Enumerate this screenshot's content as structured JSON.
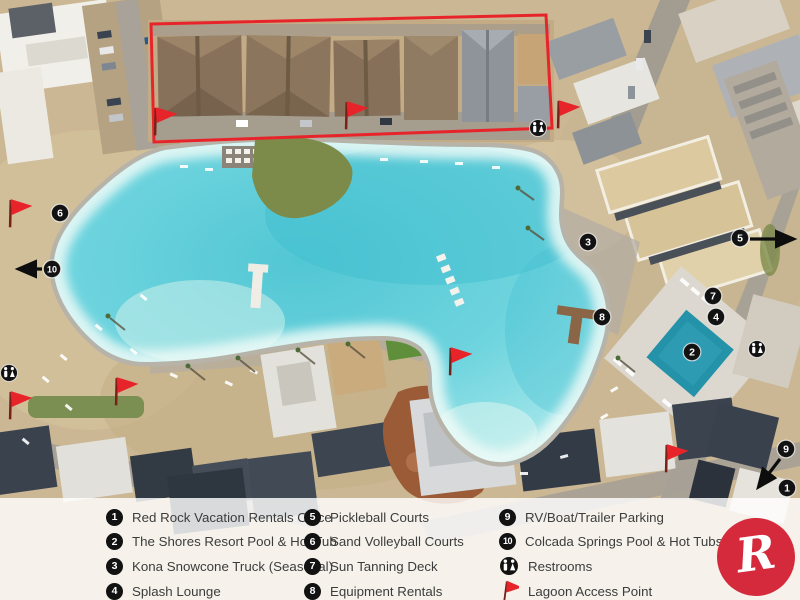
{
  "colors": {
    "accent_red": "#e8242b",
    "logo_red": "#d42a3c",
    "badge_black": "#121212",
    "water_teal": "#5fcdd8",
    "legend_text": "#3c3c3c"
  },
  "map": {
    "highlight_box_points": "151,24 546,15 552,128 154,142",
    "markers": [
      {
        "n": "1",
        "x": 787,
        "y": 488
      },
      {
        "n": "2",
        "x": 692,
        "y": 352
      },
      {
        "n": "3",
        "x": 588,
        "y": 242
      },
      {
        "n": "4",
        "x": 716,
        "y": 317
      },
      {
        "n": "5",
        "x": 740,
        "y": 238,
        "arrow": {
          "x1": 750,
          "y1": 239,
          "x2": 791,
          "y2": 239
        }
      },
      {
        "n": "6",
        "x": 60,
        "y": 213
      },
      {
        "n": "7",
        "x": 713,
        "y": 296
      },
      {
        "n": "8",
        "x": 602,
        "y": 317
      },
      {
        "n": "9",
        "x": 786,
        "y": 449,
        "arrow": {
          "x1": 780,
          "y1": 459,
          "x2": 760,
          "y2": 485
        }
      },
      {
        "n": "10",
        "x": 52,
        "y": 269,
        "arrow": {
          "x1": 42,
          "y1": 269,
          "x2": 21,
          "y2": 269
        }
      }
    ],
    "flags": [
      {
        "x": 12,
        "y": 212
      },
      {
        "x": 157,
        "y": 120
      },
      {
        "x": 348,
        "y": 114
      },
      {
        "x": 560,
        "y": 113
      },
      {
        "x": 452,
        "y": 360
      },
      {
        "x": 118,
        "y": 390
      },
      {
        "x": 12,
        "y": 404
      },
      {
        "x": 668,
        "y": 457
      }
    ],
    "restrooms": [
      {
        "x": 538,
        "y": 128
      },
      {
        "x": 9,
        "y": 373
      },
      {
        "x": 757,
        "y": 349
      }
    ]
  },
  "legend": {
    "columns": [
      {
        "items": [
          {
            "badge": "1",
            "label": "Red Rock Vacation Rentals Office"
          },
          {
            "badge": "2",
            "label": "The Shores Resort Pool & Hot Tub"
          },
          {
            "badge": "3",
            "label": "Kona Snowcone Truck (Seasonal)"
          },
          {
            "badge": "4",
            "label": "Splash Lounge"
          }
        ]
      },
      {
        "items": [
          {
            "badge": "5",
            "label": "Pickleball Courts"
          },
          {
            "badge": "6",
            "label": "Sand Volleyball Courts"
          },
          {
            "badge": "7",
            "label": "Sun Tanning Deck"
          },
          {
            "badge": "8",
            "label": "Equipment Rentals"
          }
        ]
      },
      {
        "items": [
          {
            "badge": "9",
            "label": "RV/Boat/Trailer Parking"
          },
          {
            "badge": "10",
            "label": "Colcada Springs Pool & Hot Tubs"
          },
          {
            "badge": "restroom",
            "label": "Restrooms"
          },
          {
            "badge": "flag",
            "label": "Lagoon Access Point"
          }
        ]
      }
    ]
  },
  "logo": {
    "letter": "R"
  }
}
